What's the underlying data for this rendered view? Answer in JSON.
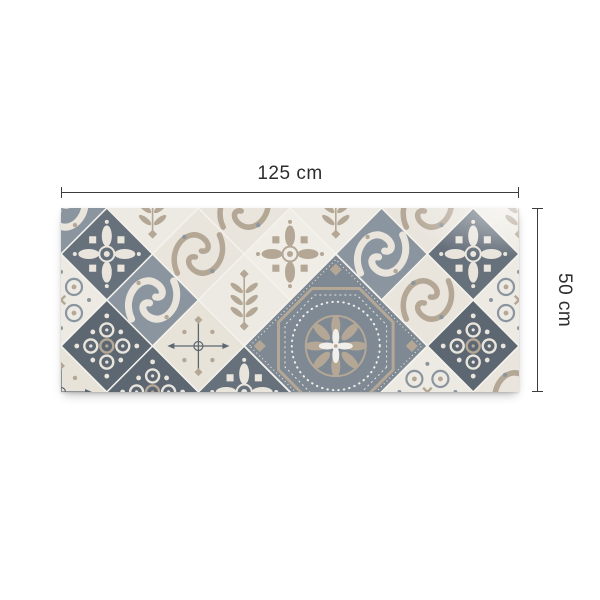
{
  "figure": {
    "type": "product-dimension-diagram",
    "product": "patchwork azulejo tile-pattern vinyl rug"
  },
  "dimensions": {
    "width_label": "125 cm",
    "height_label": "50 cm",
    "line_color": "#3c3c3c",
    "label_color": "#2d2d2d"
  },
  "rug": {
    "grid_half": 45.8,
    "cols": 11,
    "rows": 5,
    "palette": {
      "slate": "#67717c",
      "slateDark": "#5d6772",
      "gray": "#8b959f",
      "beige": "#b4a796",
      "cream": "#e9e5dd",
      "cream2": "#e7e3d9",
      "white1": "#eceae2",
      "white2": "#efede6",
      "white": "#f1efe9",
      "bigBg": "#7e8993",
      "grout": "#f4f2ec"
    },
    "tiles": [
      {
        "i": 0,
        "j": 0,
        "type": "scrollGray"
      },
      {
        "i": 2,
        "j": 0,
        "type": "damask"
      },
      {
        "i": 4,
        "j": 0,
        "type": "scrollCream"
      },
      {
        "i": 6,
        "j": 0,
        "type": "damask"
      },
      {
        "i": 8,
        "j": 0,
        "type": "scrollCream"
      },
      {
        "i": 10,
        "j": 0,
        "type": "damask"
      },
      {
        "i": 1,
        "j": 1,
        "type": "snowflake"
      },
      {
        "i": 3,
        "j": 1,
        "type": "scrollCream"
      },
      {
        "i": 5,
        "j": 1,
        "type": "snowflakeW"
      },
      {
        "i": 7,
        "j": 1,
        "type": "scrollGray"
      },
      {
        "i": 9,
        "j": 1,
        "type": "snowflake"
      },
      {
        "i": 0,
        "j": 2,
        "type": "quatrefoil"
      },
      {
        "i": 2,
        "j": 2,
        "type": "scrollGray"
      },
      {
        "i": 4,
        "j": 2,
        "type": "damask"
      },
      {
        "i": 8,
        "j": 2,
        "type": "scrollCream"
      },
      {
        "i": 10,
        "j": 2,
        "type": "quatrefoil"
      },
      {
        "i": 1,
        "j": 3,
        "type": "mosaic"
      },
      {
        "i": 3,
        "j": 3,
        "type": "compass"
      },
      {
        "i": 9,
        "j": 3,
        "type": "mosaic"
      },
      {
        "i": 0,
        "j": 4,
        "type": "compass"
      },
      {
        "i": 2,
        "j": 4,
        "type": "mosaic"
      },
      {
        "i": 4,
        "j": 4,
        "type": "snowflake"
      },
      {
        "i": 8,
        "j": 4,
        "type": "quatrefoil"
      },
      {
        "i": 10,
        "j": 4,
        "type": "scrollCream"
      }
    ],
    "big_tile": {
      "i": 6,
      "j": 3,
      "r_cells": 2,
      "type": "bigMandala"
    }
  }
}
